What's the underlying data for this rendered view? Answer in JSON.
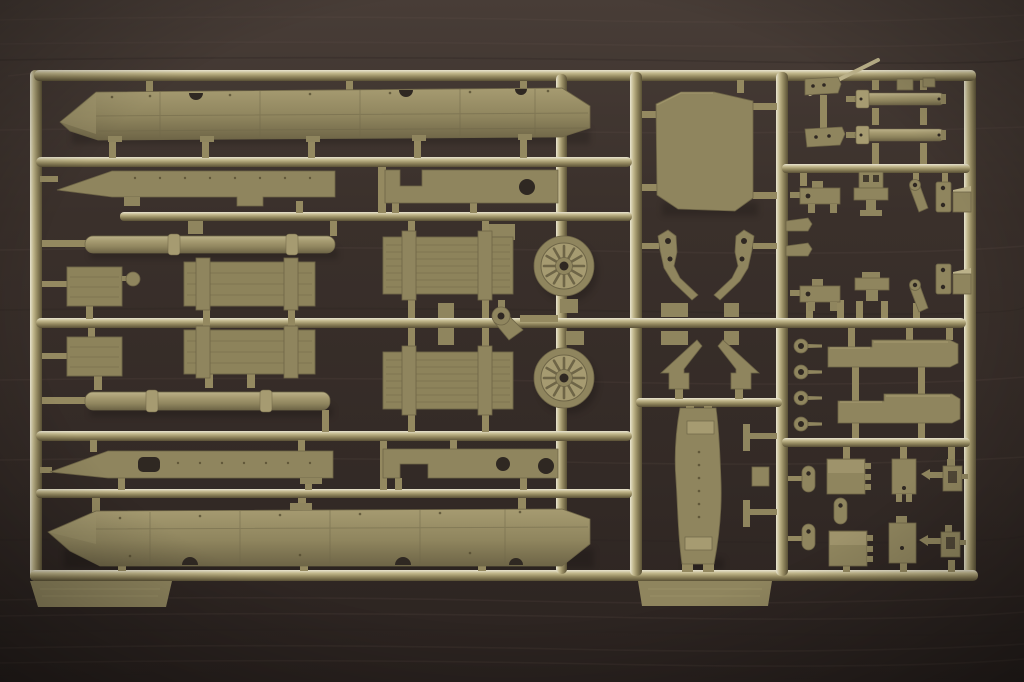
{
  "scene": {
    "type": "photograph",
    "subject": "unassembled olive-drab plastic model kit sprue (parts tree)",
    "surface": "dark brown wooden table with horizontal grain",
    "plastic_color_name": "olive drab / khaki styrene"
  },
  "photo": {
    "width": 1024,
    "height": 682
  },
  "colors": {
    "wood_base": "#3a302b",
    "wood_mid": "#332a26",
    "wood_dark": "#2b2320",
    "wood_light": "#483d37",
    "wood_grain": "#6a584e",
    "sprue_hi": "#e8e4d0",
    "sprue_mid": "#c3b98e",
    "sprue_base": "#948960",
    "sprue_low": "#5a5136",
    "part_fill": "#8f855e",
    "part_light": "#a69b71",
    "part_lighter": "#bcb28a",
    "part_shadow": "#6e6547",
    "part_dark": "#52492f",
    "hole": "#2f2822",
    "crate_fill": "#8d835b",
    "crate_line": "#746a49"
  },
  "sprue": {
    "frame": "rectangular outer runner frame, three internal vertical runners, seven horizontal runners, two molding tabs at bottom edge",
    "sections": [
      {
        "name": "left-section",
        "parts": [
          {
            "name": "upper-hull-side-panel",
            "count": 1
          },
          {
            "name": "fender-strip",
            "count": 1
          },
          {
            "name": "deck-plate-front",
            "count": 1
          },
          {
            "name": "stowage-crate-small",
            "count": 2
          },
          {
            "name": "stowage-crate-medium",
            "count": 2
          },
          {
            "name": "stowage-crate-large",
            "count": 2
          },
          {
            "name": "round-knob",
            "count": 1
          },
          {
            "name": "log-tube",
            "count": 2
          },
          {
            "name": "spoked-road-wheel",
            "count": 2
          },
          {
            "name": "winch-shackle",
            "count": 1
          },
          {
            "name": "sponson-strip",
            "count": 1
          },
          {
            "name": "deck-plate-rear",
            "count": 1
          },
          {
            "name": "lower-hull-side-panel",
            "count": 1
          },
          {
            "name": "molding-tab",
            "count": 1
          }
        ]
      },
      {
        "name": "center-column",
        "parts": [
          {
            "name": "windshield-glacis-panel",
            "count": 1
          },
          {
            "name": "lever-arm",
            "count": 2
          },
          {
            "name": "stabilizer-blade",
            "count": 2
          },
          {
            "name": "curved-track-guard",
            "count": 1
          },
          {
            "name": "t-pin",
            "count": 2
          },
          {
            "name": "spacer-block",
            "count": 5
          },
          {
            "name": "thin-rod",
            "count": 1
          },
          {
            "name": "molding-tab",
            "count": 1
          }
        ]
      },
      {
        "name": "right-column",
        "parts": [
          {
            "name": "hydraulic-cylinder",
            "count": 2
          },
          {
            "name": "small-bracket",
            "count": 10
          },
          {
            "name": "pedestal-mount",
            "count": 2
          },
          {
            "name": "bent-lever",
            "count": 2
          },
          {
            "name": "hinge-plate",
            "count": 2
          },
          {
            "name": "wedge-pin",
            "count": 2
          },
          {
            "name": "tow-eyelet",
            "count": 4
          },
          {
            "name": "stowage-rack-strip",
            "count": 2
          },
          {
            "name": "toolbox",
            "count": 2
          },
          {
            "name": "latch-box",
            "count": 2
          },
          {
            "name": "bottle-jack",
            "count": 2
          },
          {
            "name": "oval-pin",
            "count": 3
          }
        ]
      }
    ]
  }
}
